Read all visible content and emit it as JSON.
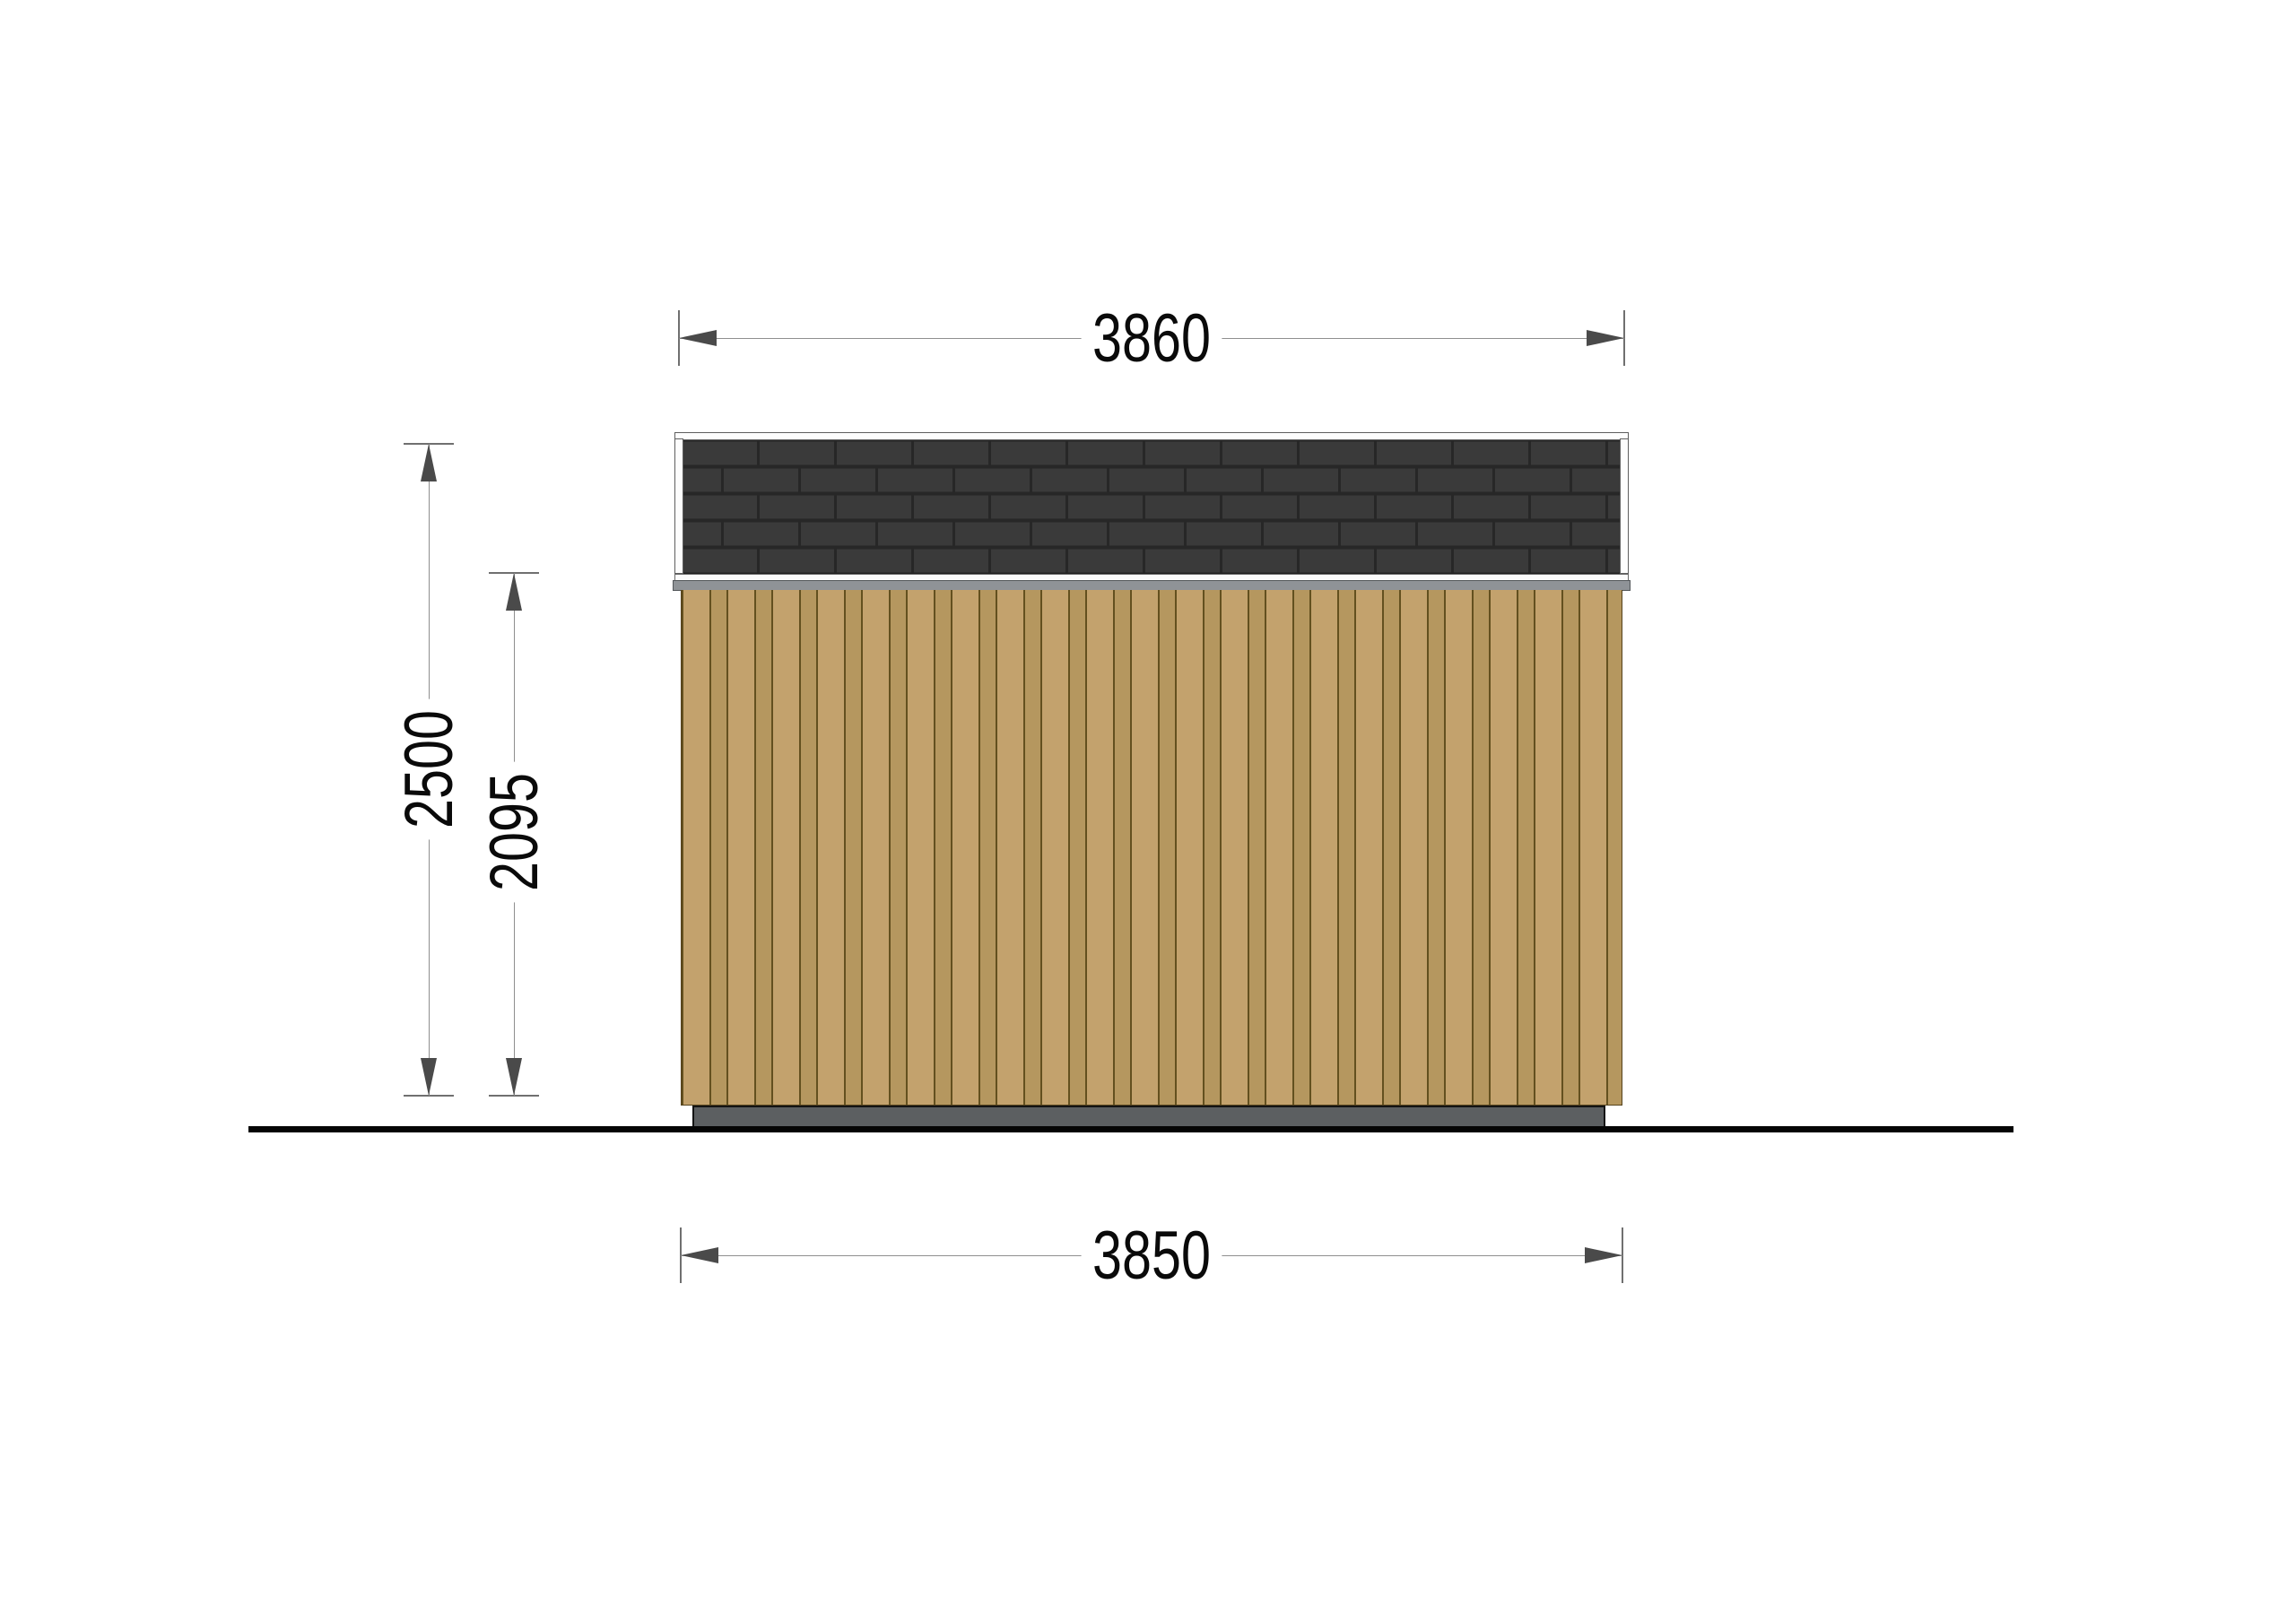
{
  "drawing": {
    "view": "side-elevation",
    "labels": {
      "roof_width": "3860",
      "base_width": "3850",
      "overall_height": "2500",
      "wall_height": "2095"
    },
    "colors": {
      "shingles": "#3a3a3a",
      "shingle_joints": "#272727",
      "roof_trim": "#fdfdfd",
      "fascia": "#8f9397",
      "siding": "#c3a26d",
      "siding_lines": "#63501f",
      "siding_batten": "#b5975f",
      "foundation": "#5c5f61",
      "ground_line": "#050505",
      "dimension_line": "#8f8f8f",
      "arrow": "#4a4a4a",
      "text": "#0a0a0a",
      "background": "#ffffff"
    }
  }
}
